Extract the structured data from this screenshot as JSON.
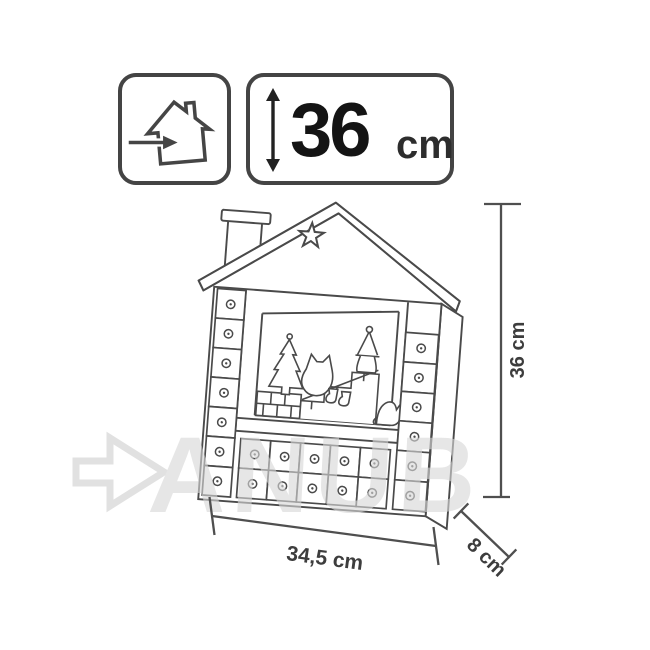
{
  "badges": {
    "indoor_use": {
      "icon": "house-arrow-indoor-icon"
    },
    "height": {
      "icon": "vertical-double-arrow-icon",
      "value": "36",
      "unit": "cm"
    }
  },
  "dimensions": {
    "height": "36 cm",
    "width": "34,5 cm",
    "depth": "8 cm"
  },
  "watermark": {
    "icon": "arrow-right-icon",
    "text": "ANUB",
    "color": "#dcdcdc"
  },
  "drawing": {
    "stroke_color": "#4a4a4a",
    "star_icon": "star-icon",
    "left_column_drawers": 7,
    "right_column_drawers": 6,
    "bottom_grid": {
      "rows": 2,
      "cols": 5
    }
  }
}
